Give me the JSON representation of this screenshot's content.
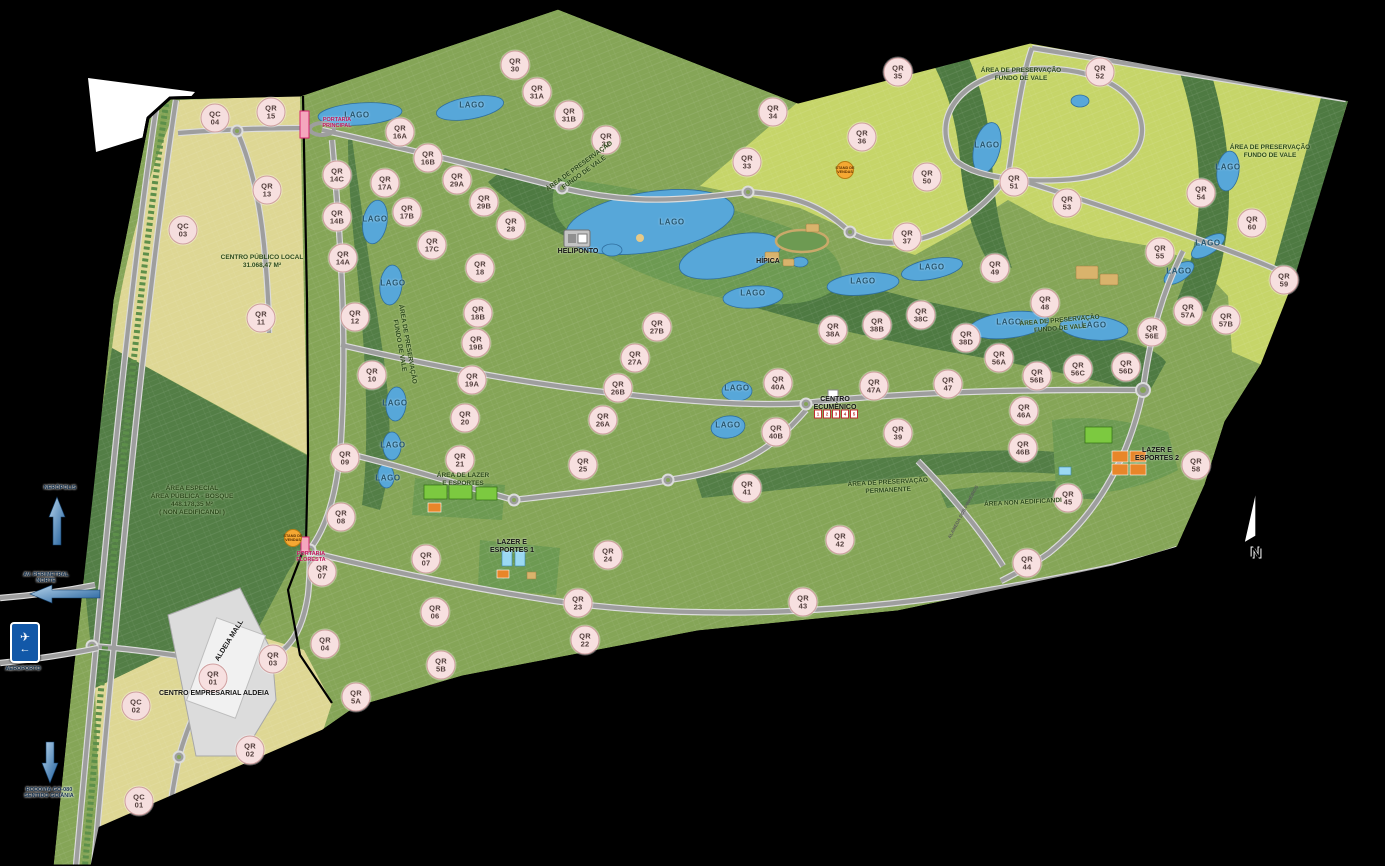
{
  "legend_colors": {
    "residential_green": "#85a557",
    "mixed_yellow_green": "#c6d569",
    "commercial_yellow": "#ded794",
    "preservation_dark_green": "#4e7a42",
    "water_blue": "#57a7d9",
    "road_gray": "#9e9e9e",
    "badge_pink": "#f7e0e0",
    "gate_pink": "#f4a7bd",
    "stand_orange": "#f5a833"
  },
  "airport_sign": {
    "plane_icon": "✈",
    "arrow_icon": "←"
  },
  "ecumenico": {
    "x": 836,
    "y": 414,
    "numbers": [
      "1",
      "2",
      "3",
      "4",
      "5"
    ]
  },
  "badges": [
    {
      "t": "QC",
      "n": "04",
      "x": 215,
      "y": 118
    },
    {
      "t": "QR",
      "n": "15",
      "x": 271,
      "y": 112
    },
    {
      "t": "QR",
      "n": "13",
      "x": 267,
      "y": 190
    },
    {
      "t": "QC",
      "n": "03",
      "x": 183,
      "y": 230
    },
    {
      "t": "QR",
      "n": "11",
      "x": 261,
      "y": 318
    },
    {
      "t": "QR",
      "n": "12",
      "x": 355,
      "y": 317
    },
    {
      "t": "QR",
      "n": "14C",
      "x": 337,
      "y": 175
    },
    {
      "t": "QR",
      "n": "14B",
      "x": 337,
      "y": 217
    },
    {
      "t": "QR",
      "n": "14A",
      "x": 343,
      "y": 258
    },
    {
      "t": "QR",
      "n": "16A",
      "x": 400,
      "y": 132
    },
    {
      "t": "QR",
      "n": "16B",
      "x": 428,
      "y": 158
    },
    {
      "t": "QR",
      "n": "17A",
      "x": 385,
      "y": 183
    },
    {
      "t": "QR",
      "n": "17B",
      "x": 407,
      "y": 212
    },
    {
      "t": "QR",
      "n": "17C",
      "x": 432,
      "y": 245
    },
    {
      "t": "QR",
      "n": "10",
      "x": 372,
      "y": 375
    },
    {
      "t": "QR",
      "n": "18",
      "x": 480,
      "y": 268
    },
    {
      "t": "QR",
      "n": "18B",
      "x": 478,
      "y": 313
    },
    {
      "t": "QR",
      "n": "19B",
      "x": 476,
      "y": 343
    },
    {
      "t": "QR",
      "n": "19A",
      "x": 472,
      "y": 380
    },
    {
      "t": "QR",
      "n": "20",
      "x": 465,
      "y": 418
    },
    {
      "t": "QR",
      "n": "21",
      "x": 460,
      "y": 460
    },
    {
      "t": "QR",
      "n": "09",
      "x": 345,
      "y": 458
    },
    {
      "t": "QR",
      "n": "08",
      "x": 341,
      "y": 517
    },
    {
      "t": "QR",
      "n": "07",
      "x": 322,
      "y": 572
    },
    {
      "t": "QR",
      "n": "07",
      "x": 426,
      "y": 559
    },
    {
      "t": "QR",
      "n": "06",
      "x": 435,
      "y": 612
    },
    {
      "t": "QR",
      "n": "5A",
      "x": 356,
      "y": 697
    },
    {
      "t": "QR",
      "n": "5B",
      "x": 441,
      "y": 665
    },
    {
      "t": "QR",
      "n": "04",
      "x": 325,
      "y": 644
    },
    {
      "t": "QR",
      "n": "03",
      "x": 273,
      "y": 659
    },
    {
      "t": "QR",
      "n": "02",
      "x": 250,
      "y": 750
    },
    {
      "t": "QR",
      "n": "01",
      "x": 213,
      "y": 678
    },
    {
      "t": "QC",
      "n": "02",
      "x": 136,
      "y": 706
    },
    {
      "t": "QC",
      "n": "01",
      "x": 139,
      "y": 801
    },
    {
      "t": "QR",
      "n": "30",
      "x": 515,
      "y": 65
    },
    {
      "t": "QR",
      "n": "31A",
      "x": 537,
      "y": 92
    },
    {
      "t": "QR",
      "n": "31B",
      "x": 569,
      "y": 115
    },
    {
      "t": "QR",
      "n": "32",
      "x": 606,
      "y": 140
    },
    {
      "t": "QR",
      "n": "29A",
      "x": 457,
      "y": 180
    },
    {
      "t": "QR",
      "n": "29B",
      "x": 484,
      "y": 202
    },
    {
      "t": "QR",
      "n": "28",
      "x": 511,
      "y": 225
    },
    {
      "t": "QR",
      "n": "25",
      "x": 583,
      "y": 465
    },
    {
      "t": "QR",
      "n": "26A",
      "x": 603,
      "y": 420
    },
    {
      "t": "QR",
      "n": "26B",
      "x": 618,
      "y": 388
    },
    {
      "t": "QR",
      "n": "27A",
      "x": 635,
      "y": 358
    },
    {
      "t": "QR",
      "n": "27B",
      "x": 657,
      "y": 327
    },
    {
      "t": "QR",
      "n": "24",
      "x": 608,
      "y": 555
    },
    {
      "t": "QR",
      "n": "23",
      "x": 578,
      "y": 603
    },
    {
      "t": "QR",
      "n": "22",
      "x": 585,
      "y": 640
    },
    {
      "t": "QR",
      "n": "34",
      "x": 773,
      "y": 112
    },
    {
      "t": "QR",
      "n": "33",
      "x": 747,
      "y": 162
    },
    {
      "t": "QR",
      "n": "35",
      "x": 898,
      "y": 72
    },
    {
      "t": "QR",
      "n": "36",
      "x": 862,
      "y": 137
    },
    {
      "t": "QR",
      "n": "37",
      "x": 907,
      "y": 237
    },
    {
      "t": "QR",
      "n": "50",
      "x": 927,
      "y": 177
    },
    {
      "t": "QR",
      "n": "51",
      "x": 1014,
      "y": 182
    },
    {
      "t": "QR",
      "n": "52",
      "x": 1100,
      "y": 72
    },
    {
      "t": "QR",
      "n": "53",
      "x": 1067,
      "y": 203
    },
    {
      "t": "QR",
      "n": "54",
      "x": 1201,
      "y": 193
    },
    {
      "t": "QR",
      "n": "55",
      "x": 1160,
      "y": 252
    },
    {
      "t": "QR",
      "n": "60",
      "x": 1252,
      "y": 223
    },
    {
      "t": "QR",
      "n": "59",
      "x": 1284,
      "y": 280
    },
    {
      "t": "QR",
      "n": "49",
      "x": 995,
      "y": 268
    },
    {
      "t": "QR",
      "n": "48",
      "x": 1045,
      "y": 303
    },
    {
      "t": "QR",
      "n": "38A",
      "x": 833,
      "y": 330
    },
    {
      "t": "QR",
      "n": "38B",
      "x": 877,
      "y": 325
    },
    {
      "t": "QR",
      "n": "38C",
      "x": 921,
      "y": 315
    },
    {
      "t": "QR",
      "n": "38D",
      "x": 966,
      "y": 338
    },
    {
      "t": "QR",
      "n": "56A",
      "x": 999,
      "y": 358
    },
    {
      "t": "QR",
      "n": "56B",
      "x": 1037,
      "y": 376
    },
    {
      "t": "QR",
      "n": "56C",
      "x": 1078,
      "y": 369
    },
    {
      "t": "QR",
      "n": "56D",
      "x": 1126,
      "y": 367
    },
    {
      "t": "QR",
      "n": "56E",
      "x": 1152,
      "y": 332
    },
    {
      "t": "QR",
      "n": "57A",
      "x": 1188,
      "y": 311
    },
    {
      "t": "QR",
      "n": "57B",
      "x": 1226,
      "y": 320
    },
    {
      "t": "QR",
      "n": "40A",
      "x": 778,
      "y": 383
    },
    {
      "t": "QR",
      "n": "40B",
      "x": 776,
      "y": 432
    },
    {
      "t": "QR",
      "n": "41",
      "x": 747,
      "y": 488
    },
    {
      "t": "QR",
      "n": "47A",
      "x": 874,
      "y": 386
    },
    {
      "t": "QR",
      "n": "47",
      "x": 948,
      "y": 384
    },
    {
      "t": "QR",
      "n": "46A",
      "x": 1024,
      "y": 411
    },
    {
      "t": "QR",
      "n": "46B",
      "x": 1023,
      "y": 448
    },
    {
      "t": "QR",
      "n": "39",
      "x": 898,
      "y": 433
    },
    {
      "t": "QR",
      "n": "45",
      "x": 1068,
      "y": 498
    },
    {
      "t": "QR",
      "n": "42",
      "x": 840,
      "y": 540
    },
    {
      "t": "QR",
      "n": "43",
      "x": 803,
      "y": 602
    },
    {
      "t": "QR",
      "n": "44",
      "x": 1027,
      "y": 563
    },
    {
      "t": "QR",
      "n": "58",
      "x": 1196,
      "y": 465
    }
  ],
  "labels": [
    {
      "cls": "lago",
      "x": 357,
      "y": 115,
      "lines": [
        "LAGO"
      ]
    },
    {
      "cls": "lago",
      "x": 472,
      "y": 105,
      "lines": [
        "LAGO"
      ]
    },
    {
      "cls": "lago",
      "x": 375,
      "y": 219,
      "lines": [
        "LAGO"
      ]
    },
    {
      "cls": "lago",
      "x": 393,
      "y": 283,
      "lines": [
        "LAGO"
      ]
    },
    {
      "cls": "lago",
      "x": 395,
      "y": 403,
      "lines": [
        "LAGO"
      ]
    },
    {
      "cls": "lago",
      "x": 393,
      "y": 445,
      "lines": [
        "LAGO"
      ]
    },
    {
      "cls": "lago",
      "x": 388,
      "y": 478,
      "lines": [
        "LAGO"
      ]
    },
    {
      "cls": "lago",
      "x": 672,
      "y": 222,
      "lines": [
        "LAGO"
      ]
    },
    {
      "cls": "lago",
      "x": 753,
      "y": 293,
      "lines": [
        "LAGO"
      ]
    },
    {
      "cls": "lago",
      "x": 737,
      "y": 388,
      "lines": [
        "LAGO"
      ]
    },
    {
      "cls": "lago",
      "x": 728,
      "y": 425,
      "lines": [
        "LAGO"
      ]
    },
    {
      "cls": "lago",
      "x": 863,
      "y": 281,
      "lines": [
        "LAGO"
      ]
    },
    {
      "cls": "lago",
      "x": 932,
      "y": 267,
      "lines": [
        "LAGO"
      ]
    },
    {
      "cls": "lago",
      "x": 1009,
      "y": 322,
      "lines": [
        "LAGO"
      ]
    },
    {
      "cls": "lago",
      "x": 1094,
      "y": 325,
      "lines": [
        "LAGO"
      ]
    },
    {
      "cls": "lago",
      "x": 987,
      "y": 145,
      "lines": [
        "LAGO"
      ]
    },
    {
      "cls": "lago",
      "x": 1228,
      "y": 167,
      "lines": [
        "LAGO"
      ]
    },
    {
      "cls": "lago",
      "x": 1208,
      "y": 243,
      "lines": [
        "LAGO"
      ]
    },
    {
      "cls": "lago",
      "x": 1179,
      "y": 271,
      "lines": [
        "LAGO"
      ]
    },
    {
      "cls": "area",
      "x": 582,
      "y": 170,
      "rot": -36,
      "lines": [
        "ÁREA DE PRESERVAÇÃO",
        "FUNDO DE VALE"
      ]
    },
    {
      "cls": "area",
      "x": 1060,
      "y": 325,
      "rot": -5,
      "lines": [
        "ÁREA DE PRESERVAÇÃO",
        "FUNDO DE VALE"
      ]
    },
    {
      "cls": "area",
      "x": 1021,
      "y": 75,
      "lines": [
        "ÁREA DE PRESERVAÇÃO",
        "FUNDO DE VALE"
      ]
    },
    {
      "cls": "area",
      "x": 1270,
      "y": 152,
      "lines": [
        "ÁREA DE PRESERVAÇÃO",
        "FUNDO DE VALE"
      ]
    },
    {
      "cls": "area",
      "x": 403,
      "y": 345,
      "rot": 80,
      "lines": [
        "ÁREA DE PRESERVAÇÃO",
        "FUNDO DE VALE"
      ]
    },
    {
      "cls": "area",
      "x": 888,
      "y": 487,
      "rot": -3,
      "lines": [
        "ÁREA DE PRESERVAÇÃO",
        "PERMANENTE"
      ]
    },
    {
      "cls": "area",
      "x": 1023,
      "y": 503,
      "rot": -3,
      "lines": [
        "ÁREA NON AEDIFICANDI"
      ]
    },
    {
      "cls": "area",
      "x": 192,
      "y": 501,
      "lines": [
        "ÁREA ESPECIAL",
        "ÁREA PÚBLICA - BOSQUE",
        "448.178,35 M²",
        "( NON AEDIFICANDI )"
      ]
    },
    {
      "cls": "area",
      "x": 262,
      "y": 262,
      "lines": [
        "CENTRO PÚBLICO LOCAL",
        "31.068,47 M²"
      ]
    },
    {
      "cls": "fac",
      "x": 578,
      "y": 252,
      "lines": [
        "HELIPONTO"
      ]
    },
    {
      "cls": "fac",
      "x": 768,
      "y": 262,
      "lines": [
        "HÍPICA"
      ]
    },
    {
      "cls": "fac",
      "x": 835,
      "y": 404,
      "lines": [
        "CENTRO",
        "ECUMÊNICO"
      ]
    },
    {
      "cls": "fac",
      "x": 230,
      "y": 641,
      "rot": -58,
      "lines": [
        "ALDEIA MALL"
      ]
    },
    {
      "cls": "fac",
      "x": 214,
      "y": 694,
      "lines": [
        "CENTRO EMPRESARIAL ALDEIA"
      ]
    },
    {
      "cls": "area",
      "x": 463,
      "y": 480,
      "lines": [
        "ÁREA DE LAZER",
        "E ESPORTES"
      ]
    },
    {
      "cls": "fac",
      "x": 512,
      "y": 547,
      "lines": [
        "LAZER E",
        "ESPORTES 1"
      ]
    },
    {
      "cls": "fac",
      "x": 1157,
      "y": 455,
      "lines": [
        "LAZER E",
        "ESPORTES 2"
      ]
    },
    {
      "cls": "street",
      "x": 963,
      "y": 512,
      "rot": -62,
      "lines": [
        "ALAMEDA DOS PINHEIROS"
      ]
    },
    {
      "cls": "porta",
      "x": 337,
      "y": 123,
      "lines": [
        "PORTARIA",
        "PRINCIPAL"
      ]
    },
    {
      "cls": "porta",
      "x": 311,
      "y": 557,
      "lines": [
        "PORTARIA",
        "FLORESTA"
      ]
    },
    {
      "cls": "stand",
      "x": 293,
      "y": 538,
      "lines": [
        "STAND DE",
        "VENDAS"
      ]
    },
    {
      "cls": "stand",
      "x": 845,
      "y": 170,
      "lines": [
        "STAND DE",
        "VENDAS"
      ]
    },
    {
      "cls": "city",
      "x": 60,
      "y": 488,
      "lines": [
        "NERÓPOLIS"
      ]
    },
    {
      "cls": "city",
      "x": 46,
      "y": 578,
      "lines": [
        "AV. PERIMETRAL",
        "NORTE"
      ]
    },
    {
      "cls": "city",
      "x": 49,
      "y": 793,
      "lines": [
        "RODOVIA GO-080",
        "SENTIDO GOIÂNIA"
      ]
    },
    {
      "cls": "city",
      "x": 23,
      "y": 669,
      "lines": [
        "AEROPORTO"
      ]
    },
    {
      "cls": "compassN",
      "x": 1256,
      "y": 553,
      "lines": [
        "N"
      ]
    }
  ]
}
